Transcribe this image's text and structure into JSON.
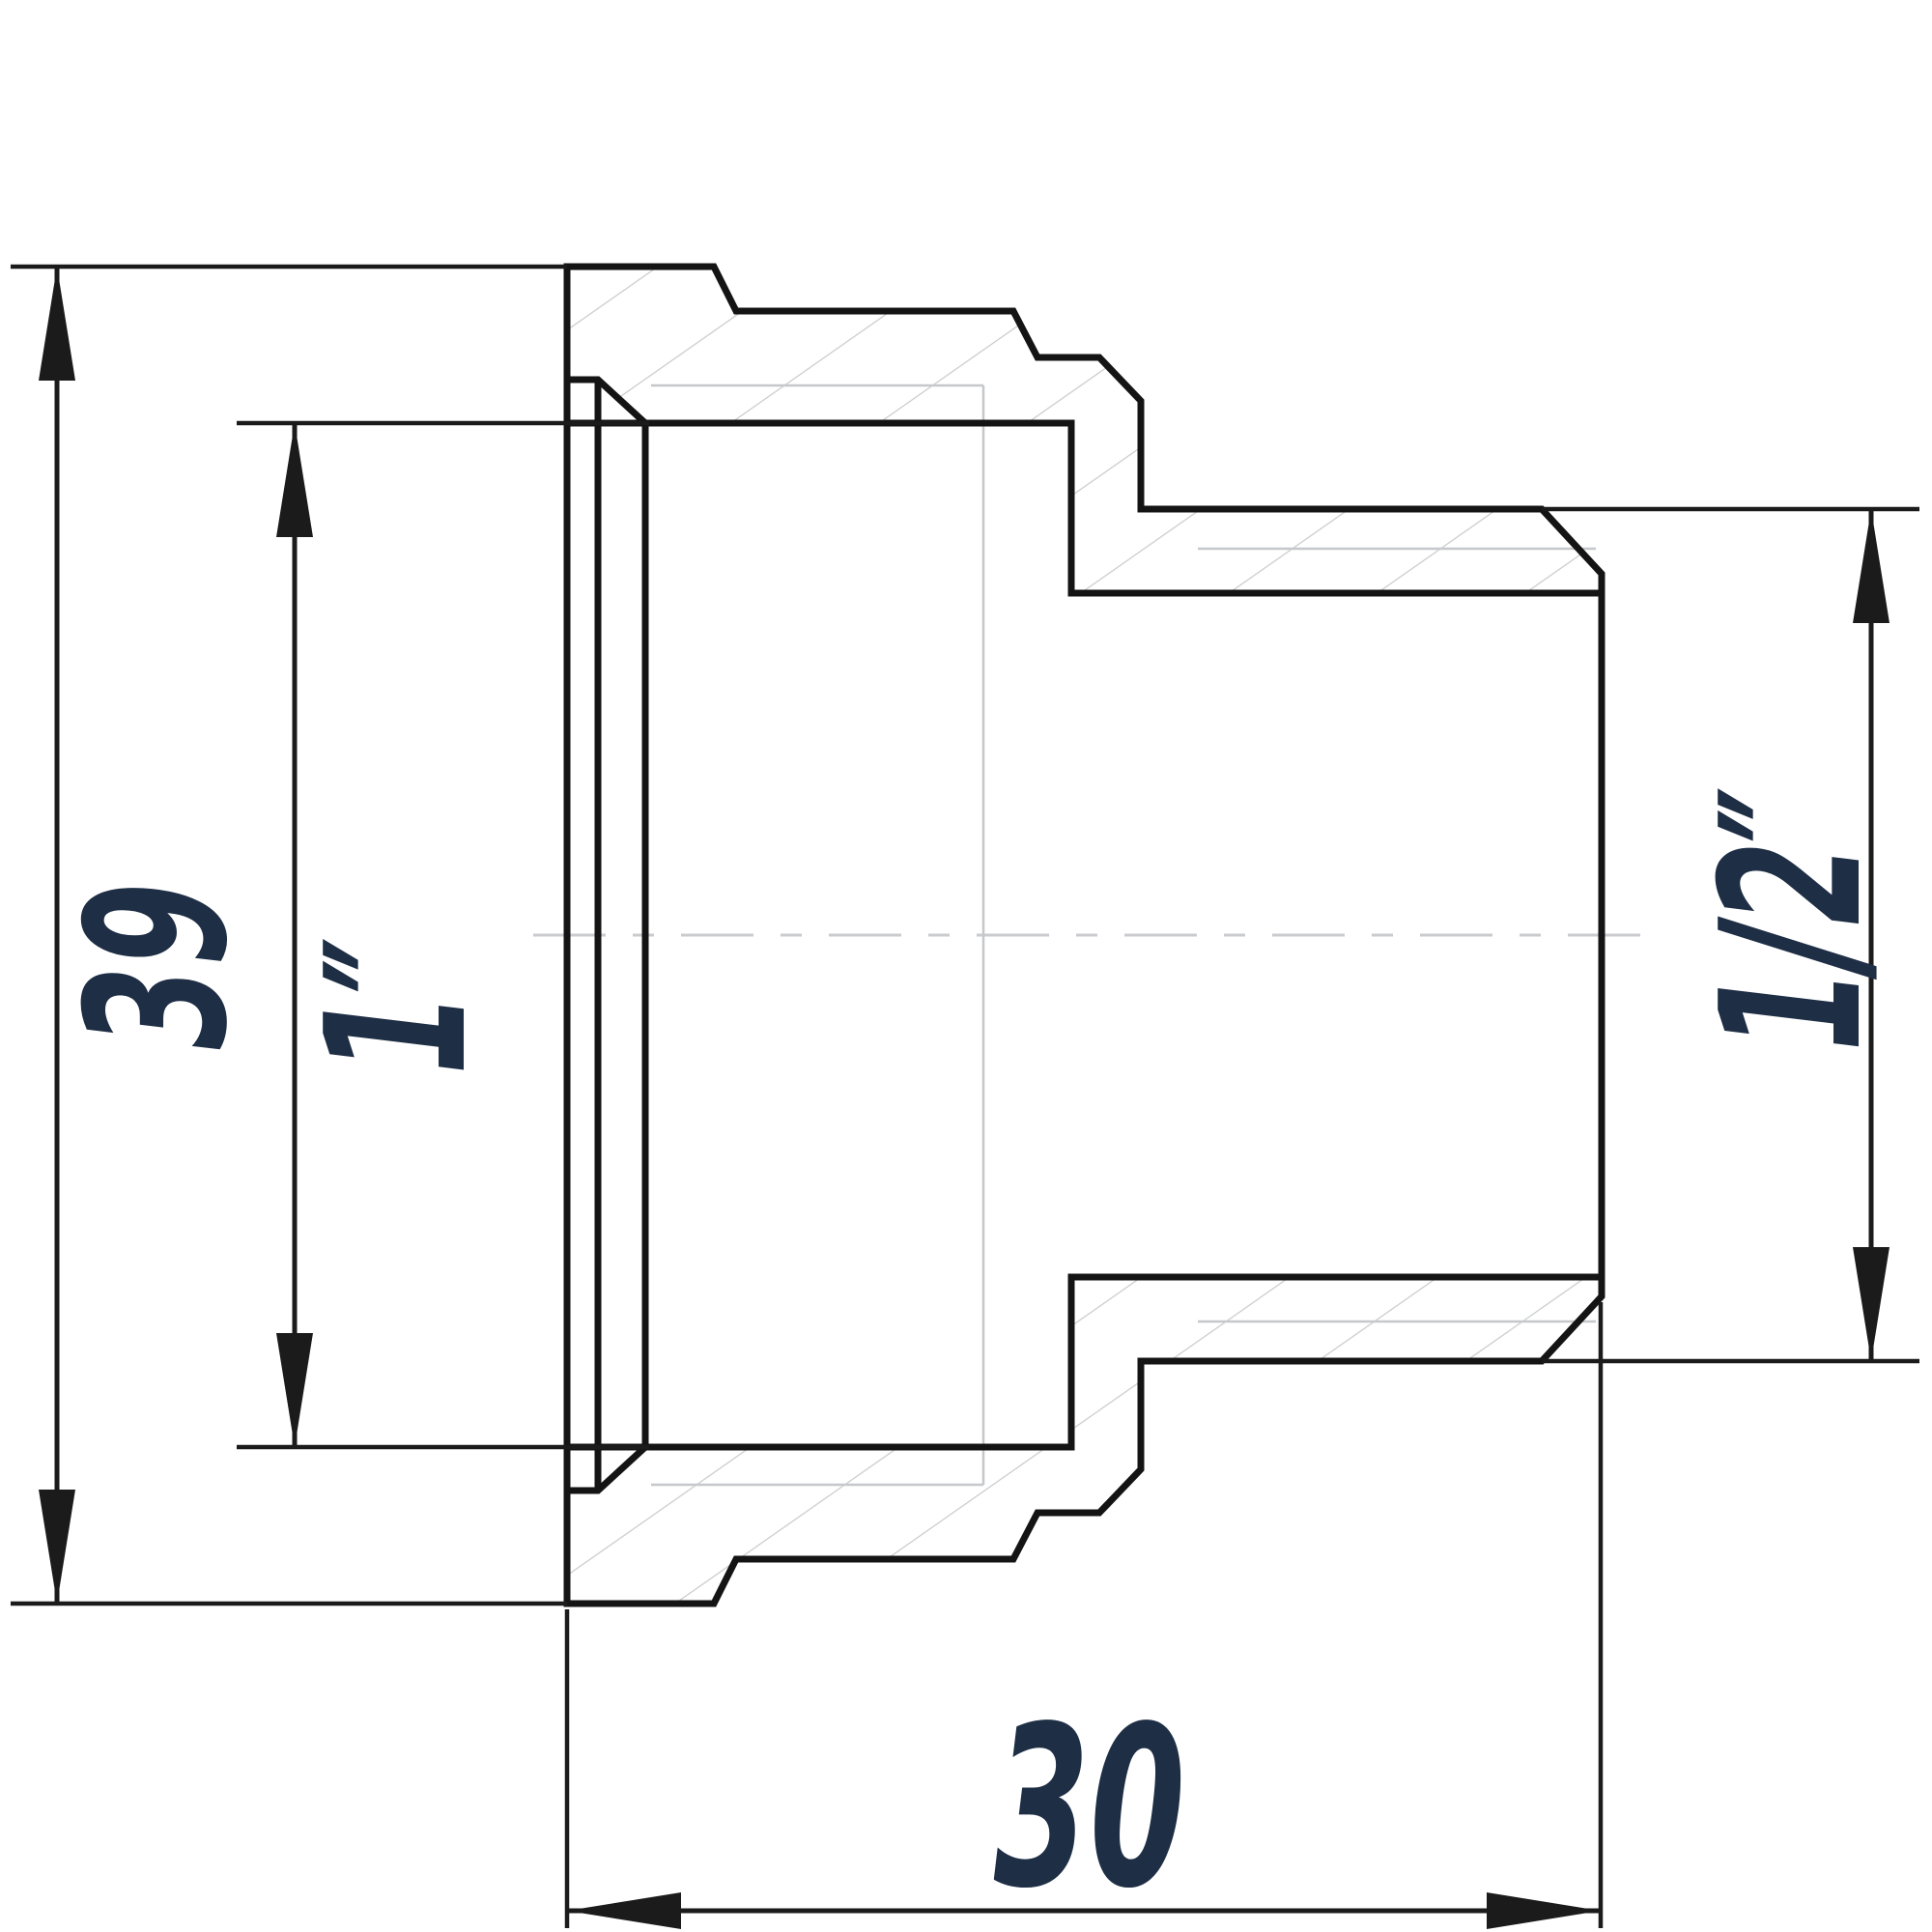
{
  "drawing": {
    "type": "technical-cross-section",
    "part": "threaded-reducing-adapter",
    "dims": {
      "outer_diameter": "39",
      "female_thread": "1″",
      "male_thread": "1/2″",
      "length": "30"
    },
    "colors": {
      "background": "#ffffff",
      "outline": "#141414",
      "dimension_lines": "#1b1b1b",
      "labels": "#1e2e45",
      "thin_lines": "#c5c7cb",
      "hatch": "#c9cbce"
    }
  }
}
